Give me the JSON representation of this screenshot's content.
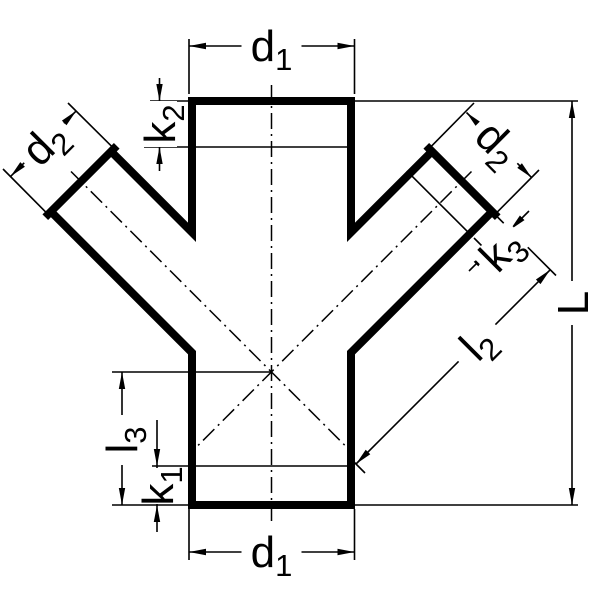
{
  "figure": {
    "kind": "technical line drawing",
    "subject": "45-degree double Y-branch (double wye) pipe fitting, dimensioned outline view",
    "ink_color": "#000000",
    "paper_color": "#ffffff"
  },
  "labels": {
    "d1_top": {
      "base": "d",
      "sub": "1"
    },
    "d2_left": {
      "base": "d",
      "sub": "2"
    },
    "k2": {
      "base": "k",
      "sub": "2"
    },
    "d2_right": {
      "base": "d",
      "sub": "2"
    },
    "k3": {
      "base": "k",
      "sub": "3"
    },
    "L": {
      "base": "L",
      "sub": ""
    },
    "l2": {
      "base": "l",
      "sub": "2"
    },
    "l3": {
      "base": "l",
      "sub": "3"
    },
    "k1": {
      "base": "k",
      "sub": "1"
    },
    "d1_bottom": {
      "base": "d",
      "sub": "1"
    }
  }
}
